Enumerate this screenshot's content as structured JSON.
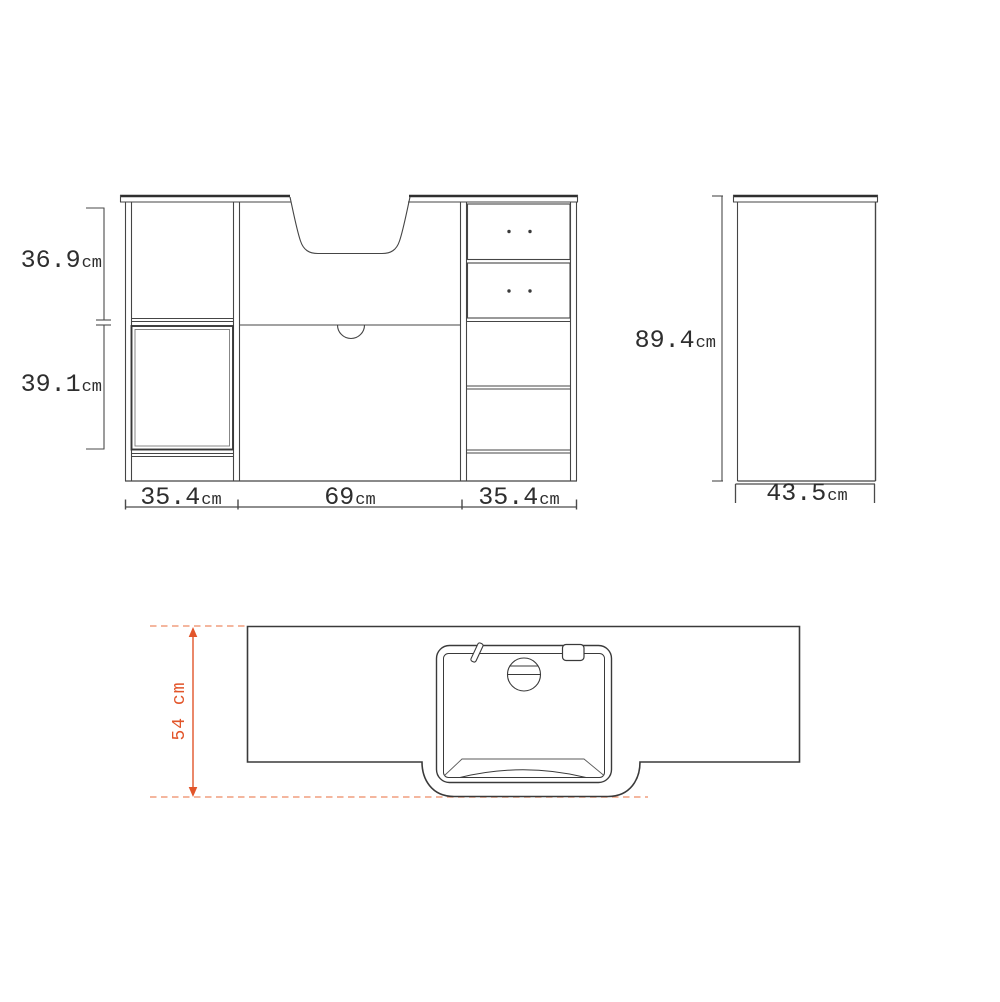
{
  "drawing": {
    "front_view": {
      "upper_height": {
        "value": "36.9",
        "unit": "cm"
      },
      "lower_height": {
        "value": "39.1",
        "unit": "cm"
      },
      "left_section_width": {
        "value": "35.4",
        "unit": "cm"
      },
      "center_section_width": {
        "value": "69",
        "unit": "cm"
      },
      "right_section_width": {
        "value": "35.4",
        "unit": "cm"
      }
    },
    "side_view": {
      "overall_height": {
        "value": "89.4",
        "unit": "cm"
      },
      "depth": {
        "value": "43.5",
        "unit": "cm"
      }
    },
    "top_view": {
      "overall_depth_label": "54 cm"
    },
    "colors": {
      "line": "#454545",
      "accent": "#e2552a",
      "accent_light": "#f2ac90"
    }
  }
}
